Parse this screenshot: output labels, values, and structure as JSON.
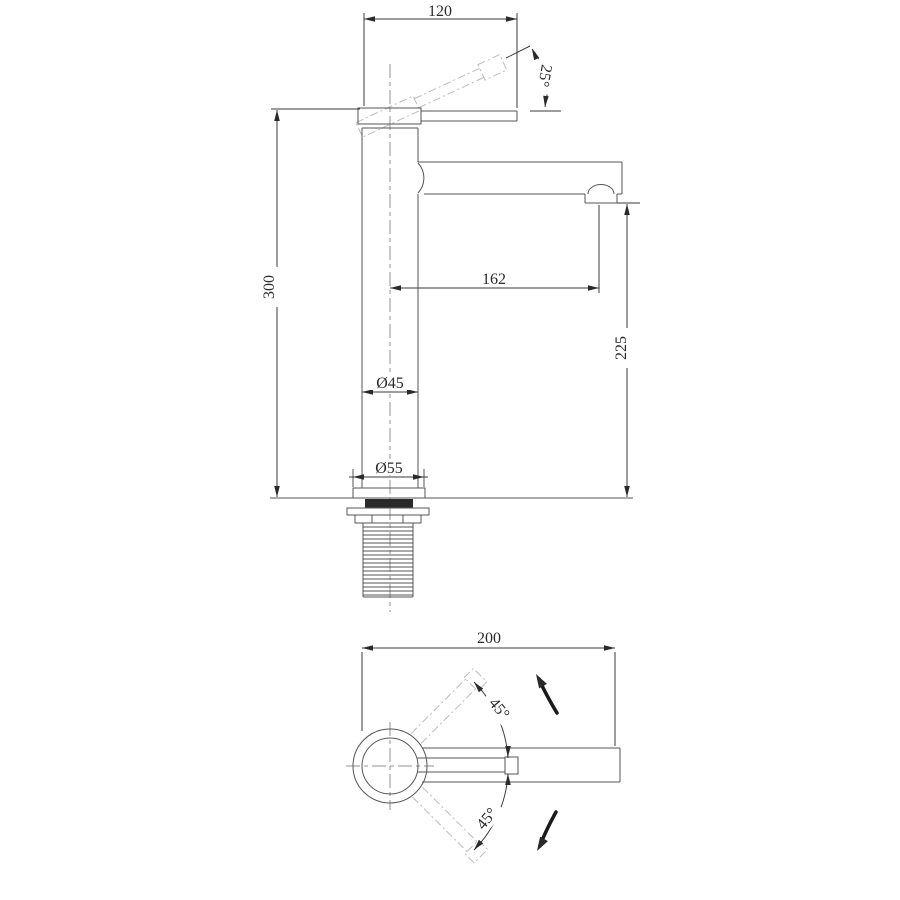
{
  "side_view": {
    "width_dim": "120",
    "handle_angle": "25°",
    "height_dim": "300",
    "spout_reach_dim": "162",
    "spout_height_dim": "225",
    "body_diameter_dim": "Ø45",
    "base_diameter_dim": "Ø55"
  },
  "plan_view": {
    "depth_dim": "200",
    "swivel_upper": "45°",
    "swivel_lower": "45°"
  },
  "colors": {
    "background": "#ffffff",
    "outline": "#555555",
    "dimension": "#3a3a3a",
    "ghost_dashed": "#bcbcbc",
    "centerline": "#909090",
    "gasket_fill": "#000000"
  }
}
